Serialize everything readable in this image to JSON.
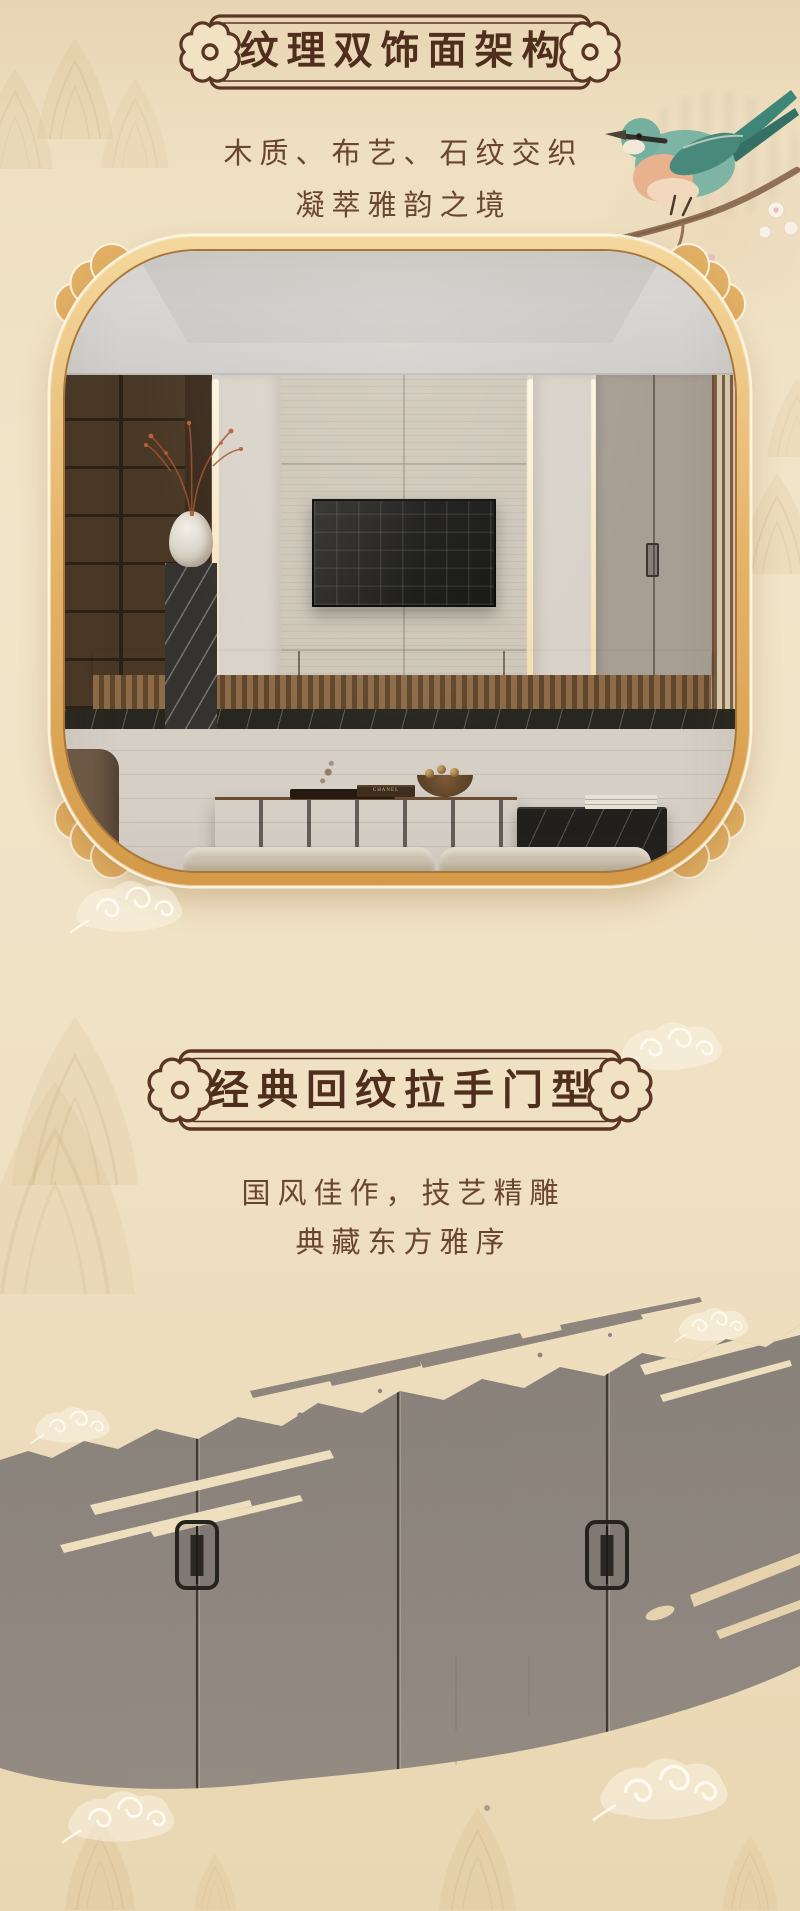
{
  "page": {
    "width": 800,
    "height": 1911,
    "background_color": "#f0e2c5",
    "ink_color": "#4f2e1d",
    "gold_frame_color": "#e7b66c",
    "cabinet_door_color": "#8e867e"
  },
  "section1": {
    "title": "纹理双饰面架构",
    "subtitle_line1": "木质、布艺、石纹交织",
    "subtitle_line2": "凝萃雅韵之境"
  },
  "section2": {
    "title": "经典回纹拉手门型",
    "subtitle_line1": "国风佳作，技艺精雕",
    "subtitle_line2": "典藏东方雅序"
  },
  "living_room": {
    "book_label": "CHANEL"
  },
  "decor": {
    "badge_ornament_icon": "cloud-medallion-with-ring",
    "bird_icon": "bird-on-blossom-branch",
    "cloud_icon": "spiral-cloud-motif",
    "mountain_icon": "misty-mountain-wash",
    "brush_icon": "ink-brush-swash"
  }
}
